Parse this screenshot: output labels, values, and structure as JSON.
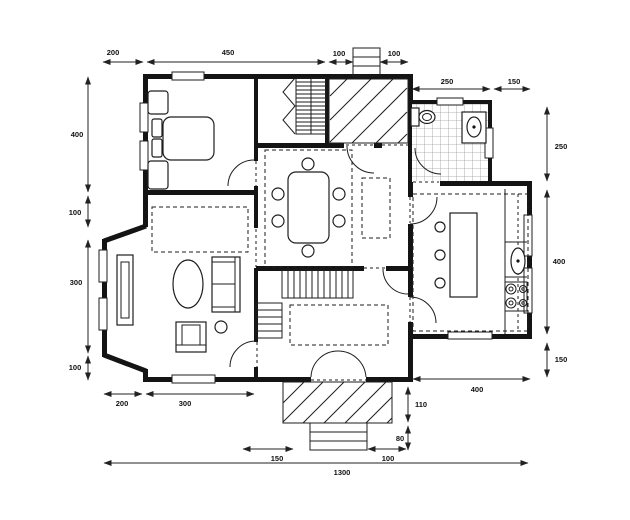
{
  "drawing": {
    "kind": "house floor plan, single storey, black line work on white"
  },
  "colors": {
    "wall": "#141414",
    "line": "#1e1e1e",
    "tile": "#9b9b9b",
    "bg": "#ffffff"
  },
  "dims": {
    "t1": "200",
    "t2": "450",
    "t3": "100",
    "t4": "100",
    "t5": "250",
    "t6": "150",
    "l1": "400",
    "l2": "100",
    "l3": "300",
    "l4": "100",
    "r1": "250",
    "r2": "400",
    "r3": "150",
    "b1": "200",
    "b2": "300",
    "b3": "400",
    "b4": "110",
    "b5": "80",
    "b6": "150",
    "b7": "100",
    "b8": "1300"
  }
}
